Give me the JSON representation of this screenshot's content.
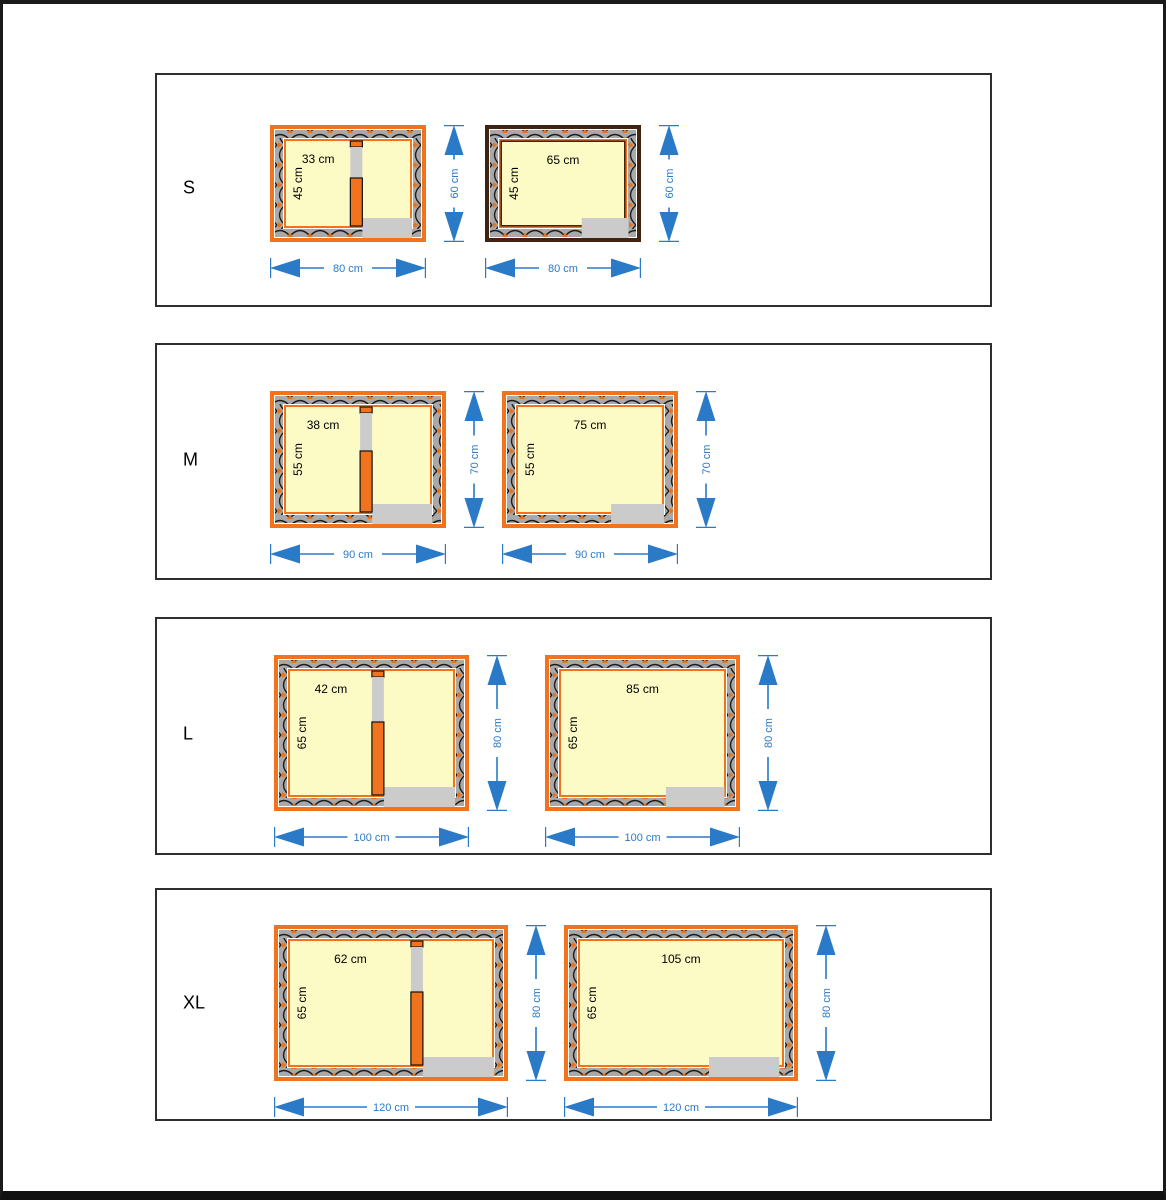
{
  "colors": {
    "orange": "#F2731D",
    "dark_frame": "#402310",
    "wall_grey": "#A9A9A9",
    "hatch_black": "#1C1C1C",
    "hatch_orange": "#E8731E",
    "interior_cream": "#FCFAC5",
    "light_grey": "#CBCBCB",
    "dim_blue": "#2A7AC8",
    "panel_border": "#2e2e2e"
  },
  "rows": [
    {
      "label": "S",
      "diagrams": [
        {
          "variant": "divided",
          "frame": "orange",
          "width_cm": 80,
          "height_cm": 60,
          "interior_width_cm": 65,
          "interior_depth_cm": 45,
          "chamber_width_cm": 33,
          "labels": {
            "chamber": "33 cm",
            "depth": "45 cm",
            "width": "80 cm",
            "height": "60 cm"
          }
        },
        {
          "variant": "open",
          "frame": "dark",
          "width_cm": 80,
          "height_cm": 60,
          "interior_width_cm": 65,
          "interior_depth_cm": 45,
          "labels": {
            "interior": "65 cm",
            "depth": "45 cm",
            "width": "80 cm",
            "height": "60 cm"
          }
        }
      ]
    },
    {
      "label": "M",
      "diagrams": [
        {
          "variant": "divided",
          "frame": "orange",
          "width_cm": 90,
          "height_cm": 70,
          "interior_width_cm": 75,
          "interior_depth_cm": 55,
          "chamber_width_cm": 38,
          "labels": {
            "chamber": "38 cm",
            "depth": "55 cm",
            "width": "90 cm",
            "height": "70 cm"
          }
        },
        {
          "variant": "open",
          "frame": "orange",
          "width_cm": 90,
          "height_cm": 70,
          "interior_width_cm": 75,
          "interior_depth_cm": 55,
          "labels": {
            "interior": "75 cm",
            "depth": "55 cm",
            "width": "90 cm",
            "height": "70 cm"
          }
        }
      ]
    },
    {
      "label": "L",
      "diagrams": [
        {
          "variant": "divided",
          "frame": "orange",
          "width_cm": 100,
          "height_cm": 80,
          "interior_width_cm": 85,
          "interior_depth_cm": 65,
          "chamber_width_cm": 42,
          "labels": {
            "chamber": "42 cm",
            "depth": "65 cm",
            "width": "100 cm",
            "height": "80 cm"
          }
        },
        {
          "variant": "open",
          "frame": "orange",
          "width_cm": 100,
          "height_cm": 80,
          "interior_width_cm": 85,
          "interior_depth_cm": 65,
          "labels": {
            "interior": "85 cm",
            "depth": "65 cm",
            "width": "100 cm",
            "height": "80 cm"
          }
        }
      ]
    },
    {
      "label": "XL",
      "diagrams": [
        {
          "variant": "divided",
          "frame": "orange",
          "width_cm": 120,
          "height_cm": 80,
          "interior_width_cm": 105,
          "interior_depth_cm": 65,
          "chamber_width_cm": 62,
          "labels": {
            "chamber": "62 cm",
            "depth": "65 cm",
            "width": "120 cm",
            "height": "80 cm"
          }
        },
        {
          "variant": "open",
          "frame": "orange",
          "width_cm": 120,
          "height_cm": 80,
          "interior_width_cm": 105,
          "interior_depth_cm": 65,
          "labels": {
            "interior": "105 cm",
            "depth": "65 cm",
            "width": "120 cm",
            "height": "80 cm"
          }
        }
      ]
    }
  ]
}
